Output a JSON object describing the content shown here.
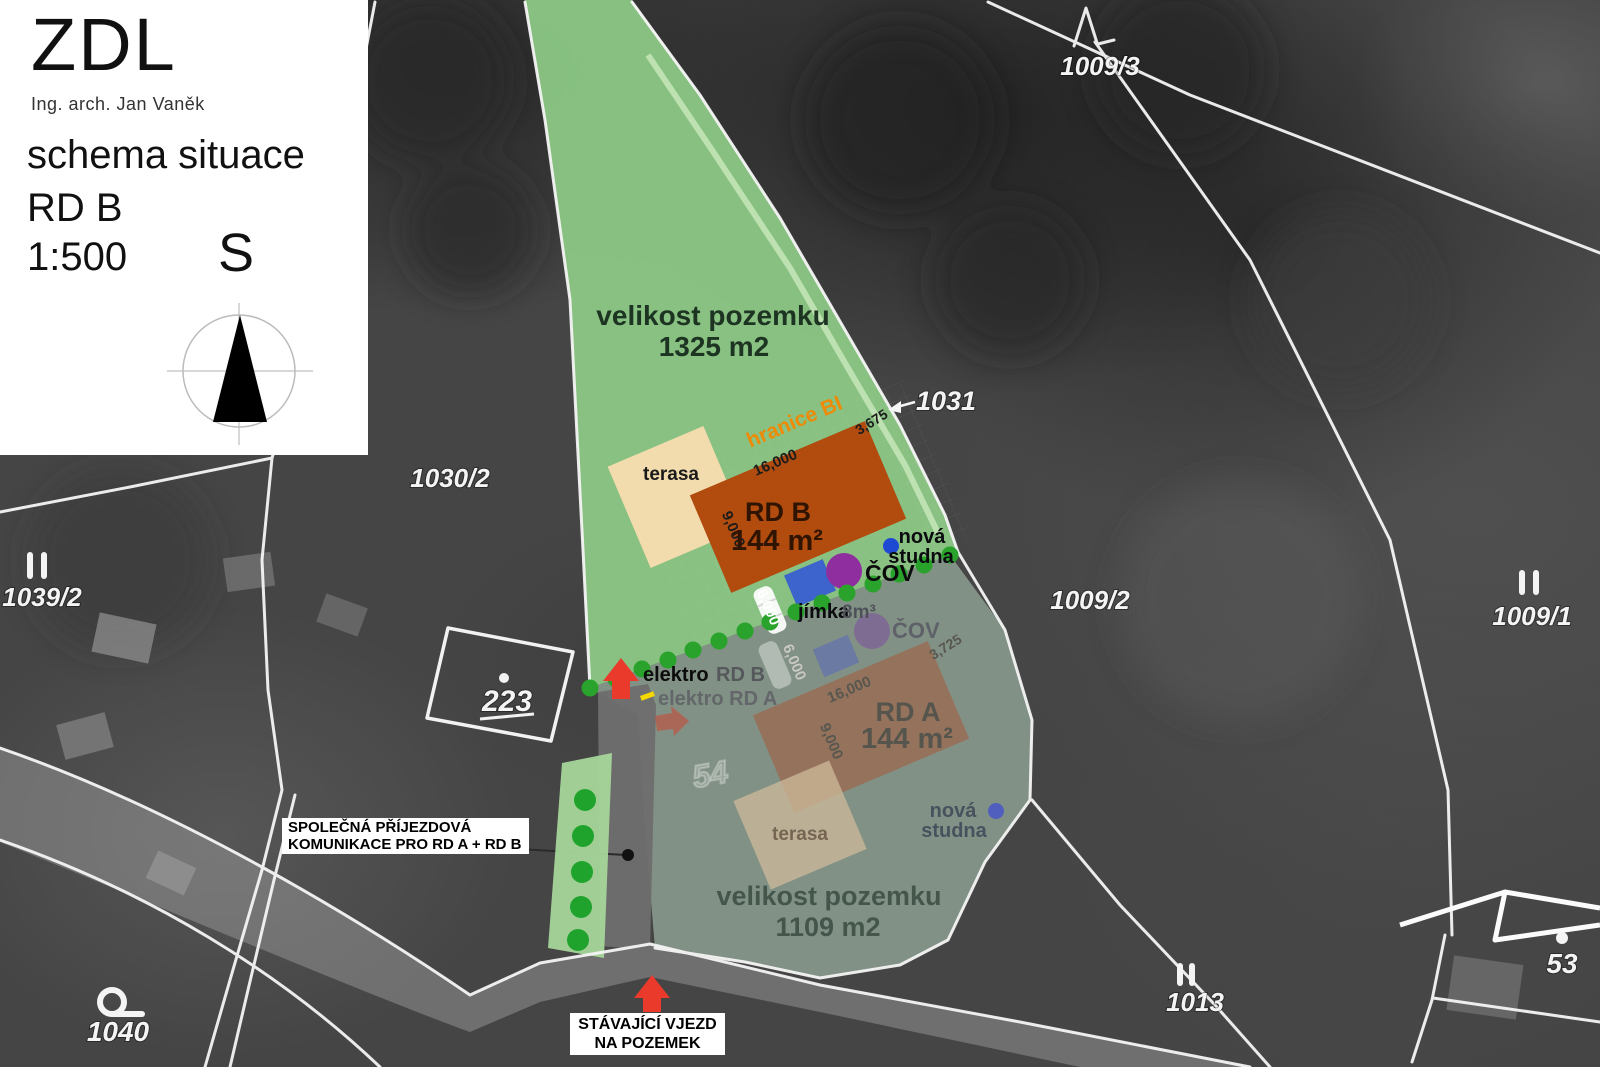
{
  "panel": {
    "logo": "ZDL",
    "architect": "Ing. arch. Jan Vaněk",
    "title": "schema situace",
    "subtitle": "RD B",
    "scale": "1:500",
    "north": "S"
  },
  "parcels": {
    "n1009_3": "1009/3",
    "n1030_2": "1030/2",
    "n1039_2": "1039/2",
    "n223": "223",
    "n1009_2": "1009/2",
    "n1009_1": "1009/1",
    "n1031": "1031",
    "n1013": "1013",
    "n53": "53",
    "n1040": "1040",
    "n54": "54"
  },
  "site_b": {
    "area_label": "velikost pozemku",
    "area_value": "1325 m2",
    "house": "RD B",
    "house_area": "144 m²",
    "terrace": "terasa",
    "boundary": "hranice BI",
    "dim_length": "16,000",
    "dim_width": "9,000",
    "dim_offset": "3,675",
    "dim_parking": "6,000",
    "well_line1": "nová",
    "well_line2": "studna",
    "wwtp": "ČOV",
    "tank": "jímka",
    "tank_volume": "8m³",
    "electro_strong": "elektro",
    "electro_rest": "RD B"
  },
  "site_a": {
    "area_label": "velikost pozemku",
    "area_value": "1109 m2",
    "house": "RD A",
    "house_area": "144 m²",
    "terrace": "terasa",
    "dim_length": "16,000",
    "dim_width": "9,000",
    "dim_offset": "3,725",
    "dim_parking": "6,000",
    "well_line1": "nová",
    "well_line2": "studna",
    "wwtp": "ČOV",
    "electro": "elektro RD A"
  },
  "annotations": {
    "access_line1": "SPOLEČNÁ PŘÍJEZDOVÁ",
    "access_line2": "KOMUNIKACE PRO RD A + RD B",
    "entrance_line1": "STÁVAJÍCÍ VJEZD",
    "entrance_line2": "NA POZEMEK"
  },
  "colors": {
    "site_green": "#8cc985",
    "faded_overlay": "#8b9c8e",
    "house_b_orange": "#b14b0e",
    "house_a_brown": "#9a6b52",
    "terrace_cream": "#f2dcae",
    "boundary_orange": "#ef8a05",
    "hedge_green": "#29a32b",
    "arrow_red": "#e93a2c",
    "well_blue": "#1e49d2",
    "wwtp_purple": "#8f2f9f",
    "tank_blue": "#3c64cc"
  }
}
